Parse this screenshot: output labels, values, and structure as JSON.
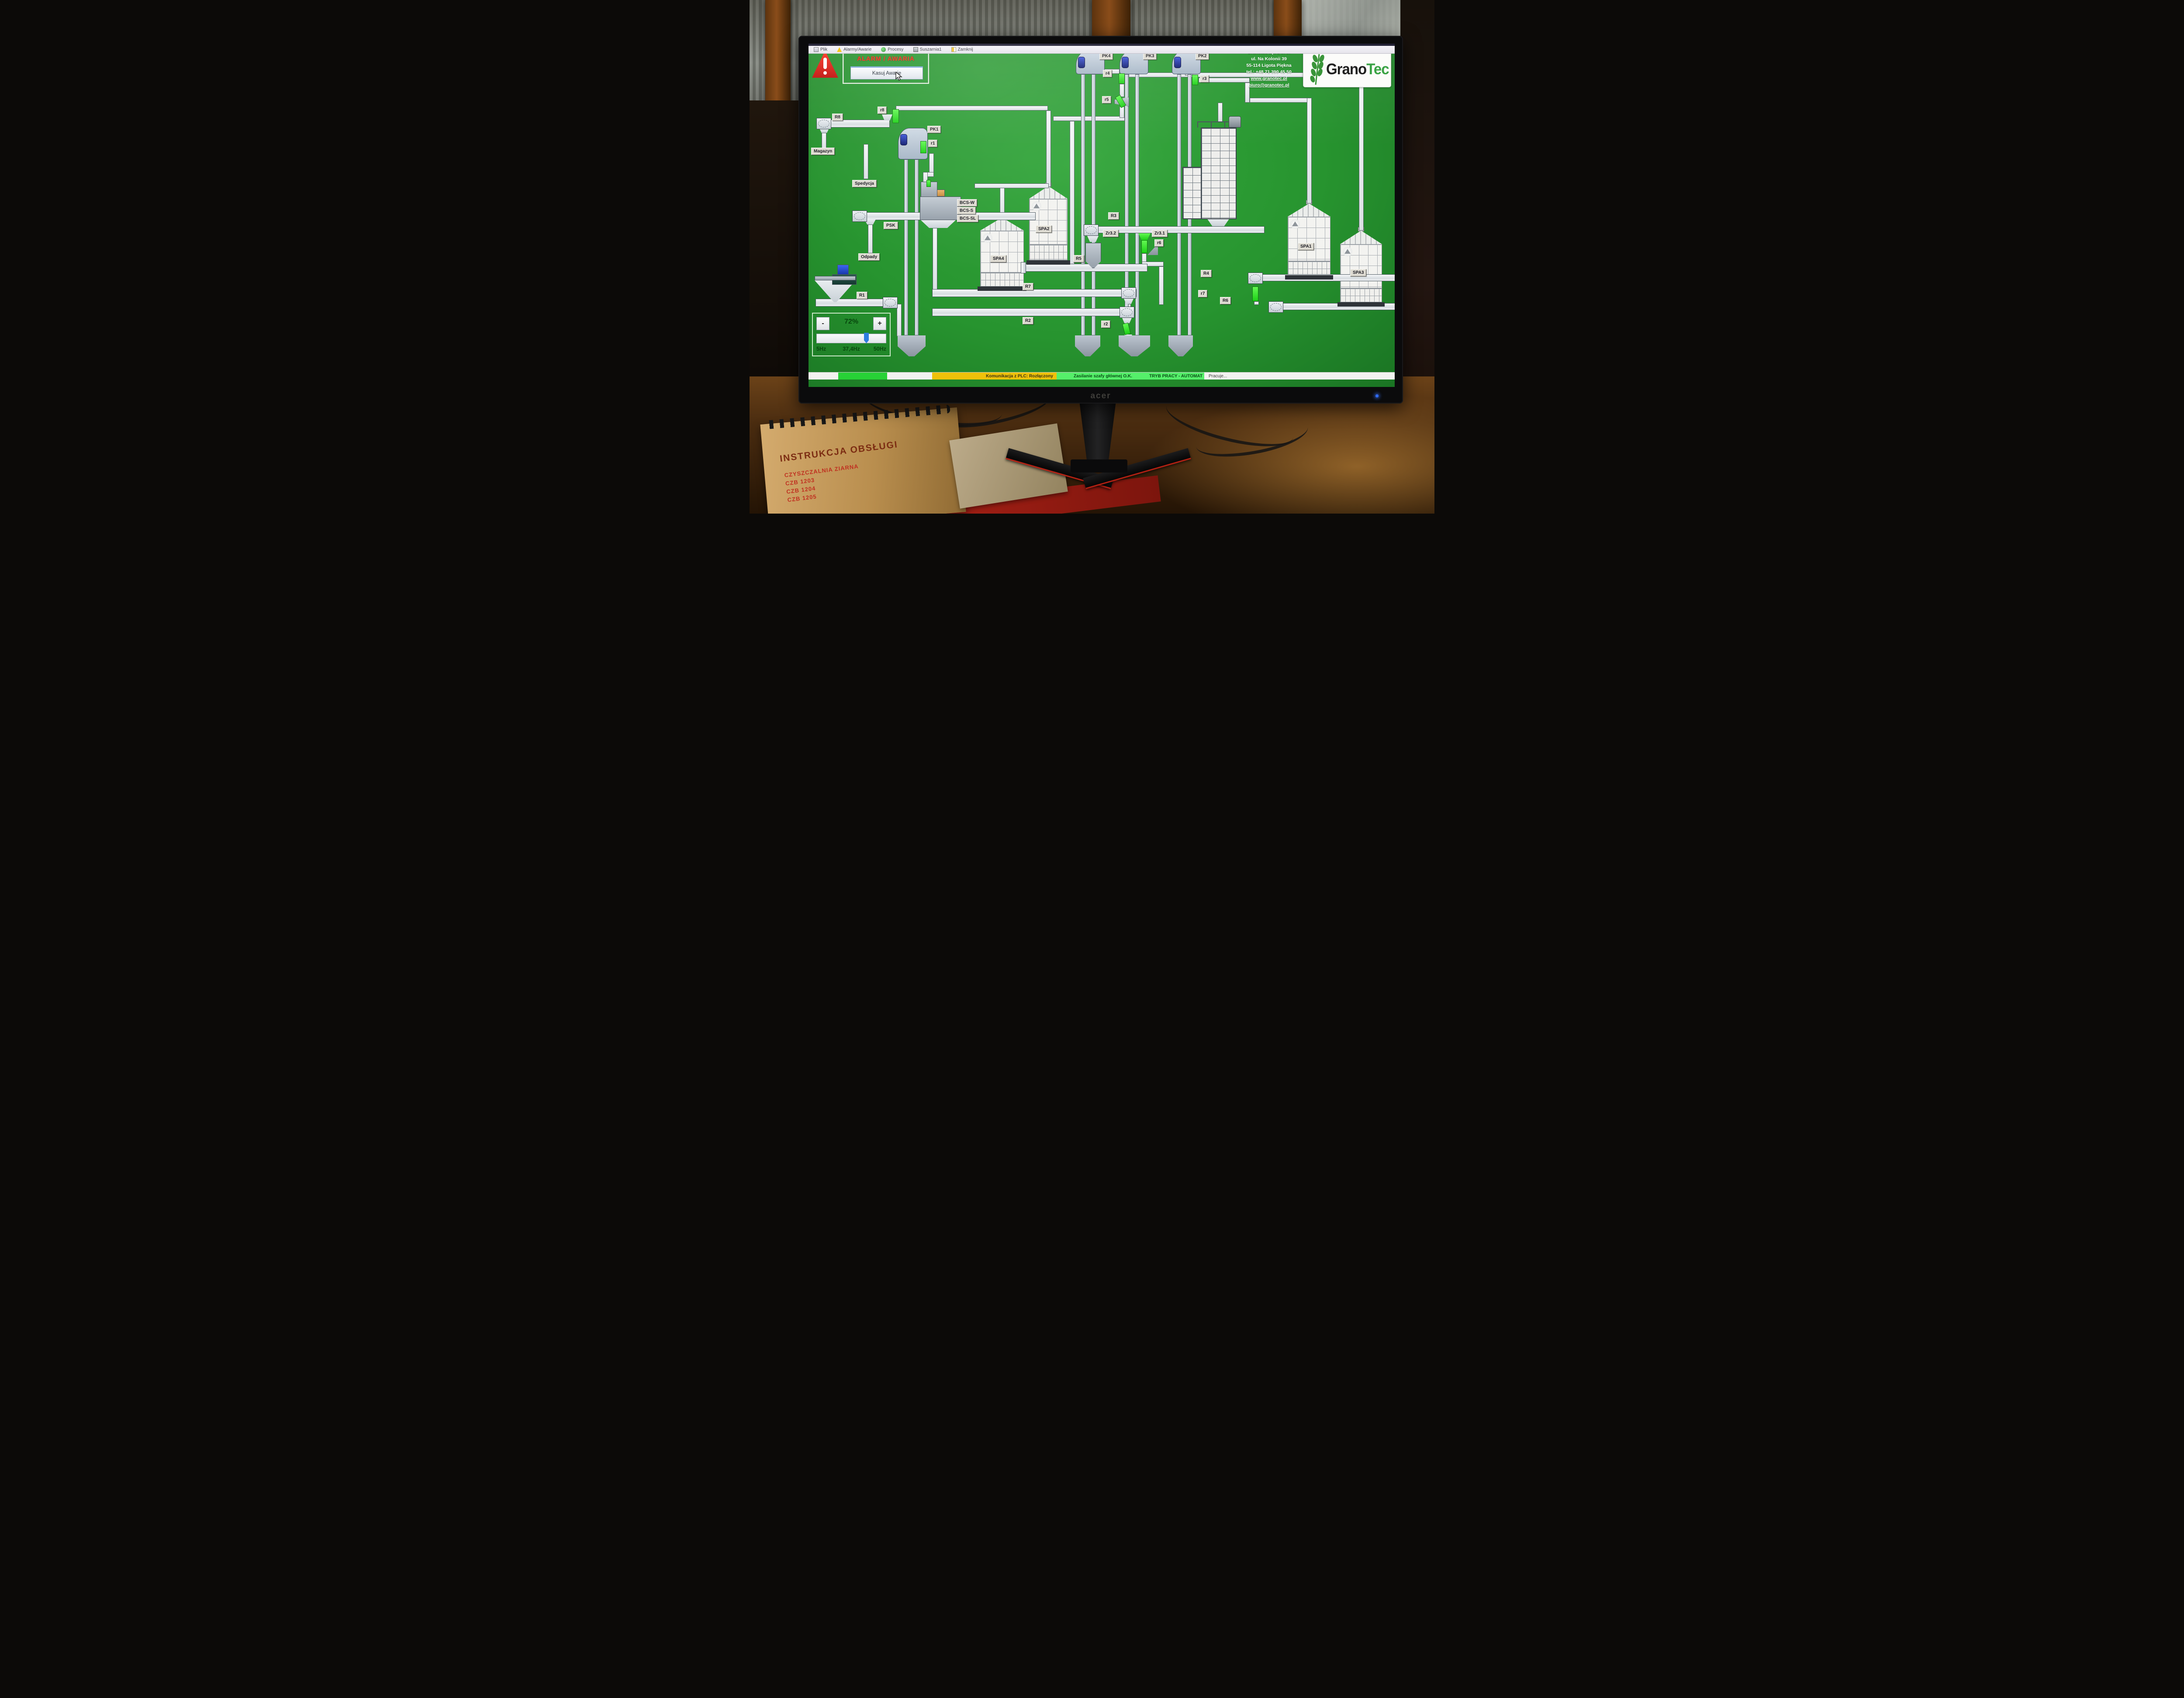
{
  "monitor": {
    "brand": "acer"
  },
  "menu": {
    "items": [
      {
        "label": "Plik",
        "icon": "file-icon"
      },
      {
        "label": "Alarmy/Awarie",
        "icon": "warning-icon"
      },
      {
        "label": "Procesy",
        "icon": "process-icon"
      },
      {
        "label": "Suszarnia1",
        "icon": "dryer-icon"
      },
      {
        "label": "Zamknij",
        "icon": "close-icon"
      }
    ]
  },
  "alarm": {
    "title": "ALARM / AWARIA",
    "button_label": "Kasuj Awarie"
  },
  "company": {
    "lines": [
      "Granotec Sp. z o. o.",
      "ul. Na Kolonii 39",
      "55-114 Ligota Piękna",
      "tel.:  +48 71 390 45 50"
    ],
    "links": [
      "www.granotec.pl",
      "biuro@granotec.pl"
    ]
  },
  "logo": {
    "part1": "Grano",
    "part2": "Tec"
  },
  "labels": [
    {
      "id": "pk4",
      "text": "PK4"
    },
    {
      "id": "pk3",
      "text": "PK3"
    },
    {
      "id": "pk2",
      "text": "PK2"
    },
    {
      "id": "v_r4",
      "text": "r4"
    },
    {
      "id": "v_r3",
      "text": "r3"
    },
    {
      "id": "v_r5",
      "text": "r5"
    },
    {
      "id": "v_r8",
      "text": "r8"
    },
    {
      "id": "c_R8",
      "text": "R8"
    },
    {
      "id": "pk1",
      "text": "PK1"
    },
    {
      "id": "v_r1",
      "text": "r1"
    },
    {
      "id": "magazyn",
      "text": "Magazyn"
    },
    {
      "id": "spedycja",
      "text": "Spedycja"
    },
    {
      "id": "bcs_w",
      "text": "BCS-W"
    },
    {
      "id": "bcs_s",
      "text": "BCS-S"
    },
    {
      "id": "bcs_sl",
      "text": "BCS-SL"
    },
    {
      "id": "psk",
      "text": "PSK"
    },
    {
      "id": "odpady",
      "text": "Odpady"
    },
    {
      "id": "spa2",
      "text": "SPA2"
    },
    {
      "id": "spa4",
      "text": "SPA4"
    },
    {
      "id": "spa1",
      "text": "SPA1"
    },
    {
      "id": "spa3",
      "text": "SPA3"
    },
    {
      "id": "c_R3",
      "text": "R3"
    },
    {
      "id": "zr32",
      "text": "Zr3.2"
    },
    {
      "id": "zr31",
      "text": "Zr3.1"
    },
    {
      "id": "v_r6",
      "text": "r6"
    },
    {
      "id": "c_R5",
      "text": "R5"
    },
    {
      "id": "c_R7",
      "text": "R7"
    },
    {
      "id": "c_R4",
      "text": "R4"
    },
    {
      "id": "v_r7",
      "text": "r7"
    },
    {
      "id": "c_R6",
      "text": "R6"
    },
    {
      "id": "c_R1",
      "text": "R1"
    },
    {
      "id": "c_R2",
      "text": "R2"
    },
    {
      "id": "v_r2",
      "text": "r2"
    }
  ],
  "frequency_panel": {
    "minus": "-",
    "plus": "+",
    "percent": "72%",
    "hz_min": "5Hz",
    "hz_current": "37,4Hz",
    "hz_max": "50Hz",
    "slider_value": 72
  },
  "status_bar": {
    "plc": "Komunikacja z PLC: Rozłączony",
    "power": "Zasilanie szafy głównej O.K.",
    "mode": "TRYB PRACY - AUTOMAT",
    "state": "Pracuje...",
    "colors": {
      "indicator_green": "#27d236",
      "warn_amber": "#eec10a",
      "ok_green": "#55ef6a"
    }
  },
  "desk": {
    "booklet": {
      "title": "INSTRUKCJA OBSŁUGI",
      "subtitle": "CZYSZCZALNIA ZIARNA",
      "models": [
        "CZB 1203",
        "CZB 1204",
        "CZB 1205"
      ]
    }
  }
}
